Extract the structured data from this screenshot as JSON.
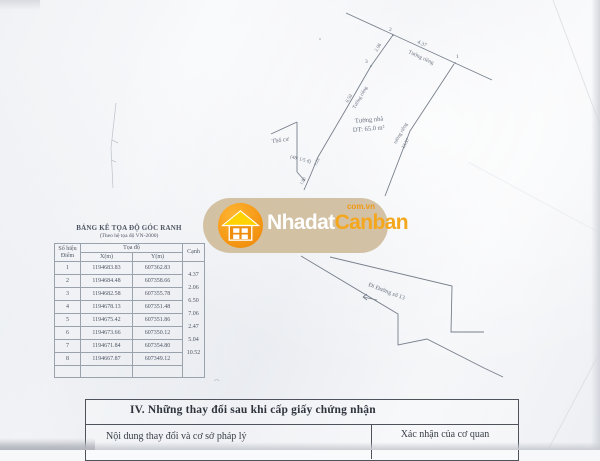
{
  "watermark": {
    "brand_first": "Nhadat",
    "brand_second": "Canban",
    "domain": "com.vn",
    "pill_color": "#cebA98",
    "circle_color": "#f79c1c",
    "roof_color": "#ffd200",
    "brand_first_color": "#ffffff",
    "brand_second_color": "#f4a71d"
  },
  "coordinate_table": {
    "title": "BẢNG KÊ TỌA ĐỘ GÓC RANH",
    "subtitle": "(Theo hệ tọa độ VN-2000)",
    "headers": {
      "point_line1": "Số hiệu",
      "point_line2": "Điểm",
      "coords": "Tọa độ",
      "x": "X(m)",
      "y": "Y(m)",
      "edge": "Cạnh"
    },
    "rows": [
      {
        "n": "1",
        "x": "1194683.83",
        "y": "607362.83"
      },
      {
        "n": "2",
        "x": "1194684.48",
        "y": "607358.66"
      },
      {
        "n": "3",
        "x": "1194682.58",
        "y": "607355.78"
      },
      {
        "n": "4",
        "x": "1194678.13",
        "y": "607351.48"
      },
      {
        "n": "5",
        "x": "1194675.42",
        "y": "607351.86"
      },
      {
        "n": "6",
        "x": "1194673.66",
        "y": "607350.12"
      },
      {
        "n": "7",
        "x": "1194671.84",
        "y": "607354.80"
      },
      {
        "n": "8",
        "x": "1194667.87",
        "y": "607349.12"
      }
    ],
    "edges": [
      "4.37",
      "2.06",
      "6.50",
      "7.06",
      "2.47",
      "5.04",
      "10.52"
    ]
  },
  "diagram": {
    "labels": {
      "point_1": "1",
      "point_2": "2",
      "point_3": "3",
      "top_edge_length": "4.37",
      "top_edge_name": "Tường riêng",
      "edge_2_3": "2.06",
      "left_edge_name": "Tường riêng",
      "left_edge_length": "6.50",
      "left_step_1": "1.25",
      "left_step_2": "1.80",
      "right_edge_name": "tường riêng",
      "right_edge_length": "13.57",
      "zone": "Thổ cư",
      "zone_note": "(48: 1/5 đ)",
      "area_line1": "Tường nhà",
      "area_line2": "DT: 65.0 m²",
      "road": "Đi Đường số 13"
    }
  },
  "section_iv": {
    "title": "IV. Những thay đổi sau khi cấp giấy chứng nhận",
    "left_header": "Nội dung thay đổi và cơ sở pháp lý",
    "right_header": "Xác nhận của cơ quan"
  }
}
